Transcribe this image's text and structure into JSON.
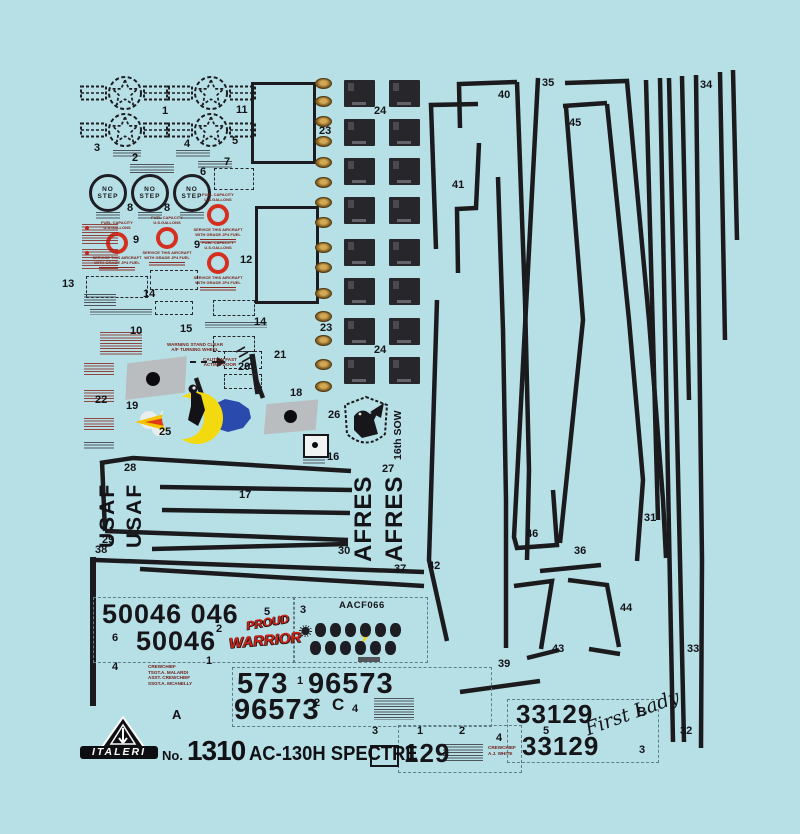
{
  "kit": {
    "brand": "ITALERI",
    "no_prefix": "No.",
    "number": "1310",
    "name": "AC-130H SPECTRE"
  },
  "stencils": {
    "no_step": "NO\nSTEP",
    "fuel_line1": "FUEL CAPACITY",
    "fuel_line2": "U.S.GALLONS",
    "service_line1": "SERVICE THIS AIRCRAFT",
    "service_line2": "WITH GRADE JP4 FUEL",
    "warning_line1": "WARNING STAND CLEAR",
    "warning_line2": "A/F TURNING WHEEL",
    "caution_line1": "CAUTION FAST",
    "caution_line2": "ACTING DOOR"
  },
  "markings": {
    "usaf": "USAF",
    "afres": "AFRES",
    "sow": "16th SOW",
    "serial_top": "50046 046",
    "serial_top2": "50046",
    "serial_573": "573",
    "serial_96573a": "96573",
    "serial_96573b": "96573",
    "serial_33129a": "33129",
    "serial_33129b": "33129",
    "serial_129": "129",
    "code_aacf": "AACF066",
    "proud_line1": "PROUD",
    "proud_line2": "WARRIOR",
    "signature": "First Lady"
  },
  "crew_block_1": {
    "line1": "CREWCHIEF",
    "line2": "TSGT.A. MALARDI",
    "line3": "ASST. CREWCHIEF",
    "line4": "SSGT.A. MCANELLY"
  },
  "crew_block_2": {
    "line1": "CREWCHIEF",
    "line2": "A.J. WHITE"
  },
  "letter_labels": [
    {
      "t": "A",
      "x": 172,
      "y": 708,
      "size": 13
    },
    {
      "t": "B",
      "x": 637,
      "y": 705,
      "size": 13
    },
    {
      "t": "C",
      "x": 332,
      "y": 696,
      "size": 17
    }
  ],
  "part_labels": [
    {
      "n": "1",
      "x": 162,
      "y": 106
    },
    {
      "n": "11",
      "x": 236,
      "y": 105
    },
    {
      "n": "3",
      "x": 94,
      "y": 143
    },
    {
      "n": "4",
      "x": 184,
      "y": 139
    },
    {
      "n": "5",
      "x": 232,
      "y": 136
    },
    {
      "n": "2",
      "x": 132,
      "y": 153
    },
    {
      "n": "7",
      "x": 224,
      "y": 157
    },
    {
      "n": "6",
      "x": 200,
      "y": 167
    },
    {
      "n": "8",
      "x": 127,
      "y": 203
    },
    {
      "n": "8",
      "x": 164,
      "y": 203
    },
    {
      "n": "9",
      "x": 133,
      "y": 235
    },
    {
      "n": "9",
      "x": 194,
      "y": 240
    },
    {
      "n": "12",
      "x": 240,
      "y": 255
    },
    {
      "n": "13",
      "x": 62,
      "y": 279
    },
    {
      "n": "14",
      "x": 143,
      "y": 289
    },
    {
      "n": "14",
      "x": 254,
      "y": 317
    },
    {
      "n": "10",
      "x": 130,
      "y": 326
    },
    {
      "n": "15",
      "x": 180,
      "y": 324
    },
    {
      "n": "20",
      "x": 238,
      "y": 362
    },
    {
      "n": "21",
      "x": 274,
      "y": 350
    },
    {
      "n": "22",
      "x": 95,
      "y": 395
    },
    {
      "n": "19",
      "x": 126,
      "y": 401
    },
    {
      "n": "25",
      "x": 159,
      "y": 427
    },
    {
      "n": "18",
      "x": 290,
      "y": 388
    },
    {
      "n": "26",
      "x": 328,
      "y": 410
    },
    {
      "n": "16",
      "x": 327,
      "y": 452
    },
    {
      "n": "27",
      "x": 382,
      "y": 464
    },
    {
      "n": "23",
      "x": 319,
      "y": 126
    },
    {
      "n": "23",
      "x": 320,
      "y": 323
    },
    {
      "n": "24",
      "x": 374,
      "y": 106
    },
    {
      "n": "24",
      "x": 374,
      "y": 345
    },
    {
      "n": "28",
      "x": 124,
      "y": 463
    },
    {
      "n": "17",
      "x": 239,
      "y": 490
    },
    {
      "n": "29",
      "x": 102,
      "y": 535
    },
    {
      "n": "30",
      "x": 338,
      "y": 546
    },
    {
      "n": "38",
      "x": 95,
      "y": 545
    },
    {
      "n": "37",
      "x": 394,
      "y": 564
    },
    {
      "n": "40",
      "x": 498,
      "y": 90
    },
    {
      "n": "35",
      "x": 542,
      "y": 78
    },
    {
      "n": "34",
      "x": 700,
      "y": 80
    },
    {
      "n": "45",
      "x": 569,
      "y": 118
    },
    {
      "n": "41",
      "x": 452,
      "y": 180
    },
    {
      "n": "31",
      "x": 644,
      "y": 513
    },
    {
      "n": "36",
      "x": 574,
      "y": 546
    },
    {
      "n": "46",
      "x": 526,
      "y": 529
    },
    {
      "n": "42",
      "x": 428,
      "y": 561
    },
    {
      "n": "44",
      "x": 620,
      "y": 603
    },
    {
      "n": "43",
      "x": 552,
      "y": 644
    },
    {
      "n": "39",
      "x": 498,
      "y": 659
    },
    {
      "n": "33",
      "x": 687,
      "y": 644
    },
    {
      "n": "32",
      "x": 680,
      "y": 726
    },
    {
      "n": "5",
      "x": 264,
      "y": 607
    },
    {
      "n": "3",
      "x": 300,
      "y": 605
    },
    {
      "n": "6",
      "x": 112,
      "y": 633
    },
    {
      "n": "2",
      "x": 216,
      "y": 624
    },
    {
      "n": "1",
      "x": 206,
      "y": 656
    },
    {
      "n": "4",
      "x": 112,
      "y": 662
    },
    {
      "n": "1",
      "x": 297,
      "y": 676
    },
    {
      "n": "2",
      "x": 314,
      "y": 698
    },
    {
      "n": "4",
      "x": 352,
      "y": 704
    },
    {
      "n": "3",
      "x": 372,
      "y": 726
    },
    {
      "n": "1",
      "x": 417,
      "y": 726
    },
    {
      "n": "2",
      "x": 459,
      "y": 726
    },
    {
      "n": "4",
      "x": 496,
      "y": 733
    },
    {
      "n": "5",
      "x": 543,
      "y": 726
    },
    {
      "n": "3",
      "x": 639,
      "y": 745
    }
  ]
}
